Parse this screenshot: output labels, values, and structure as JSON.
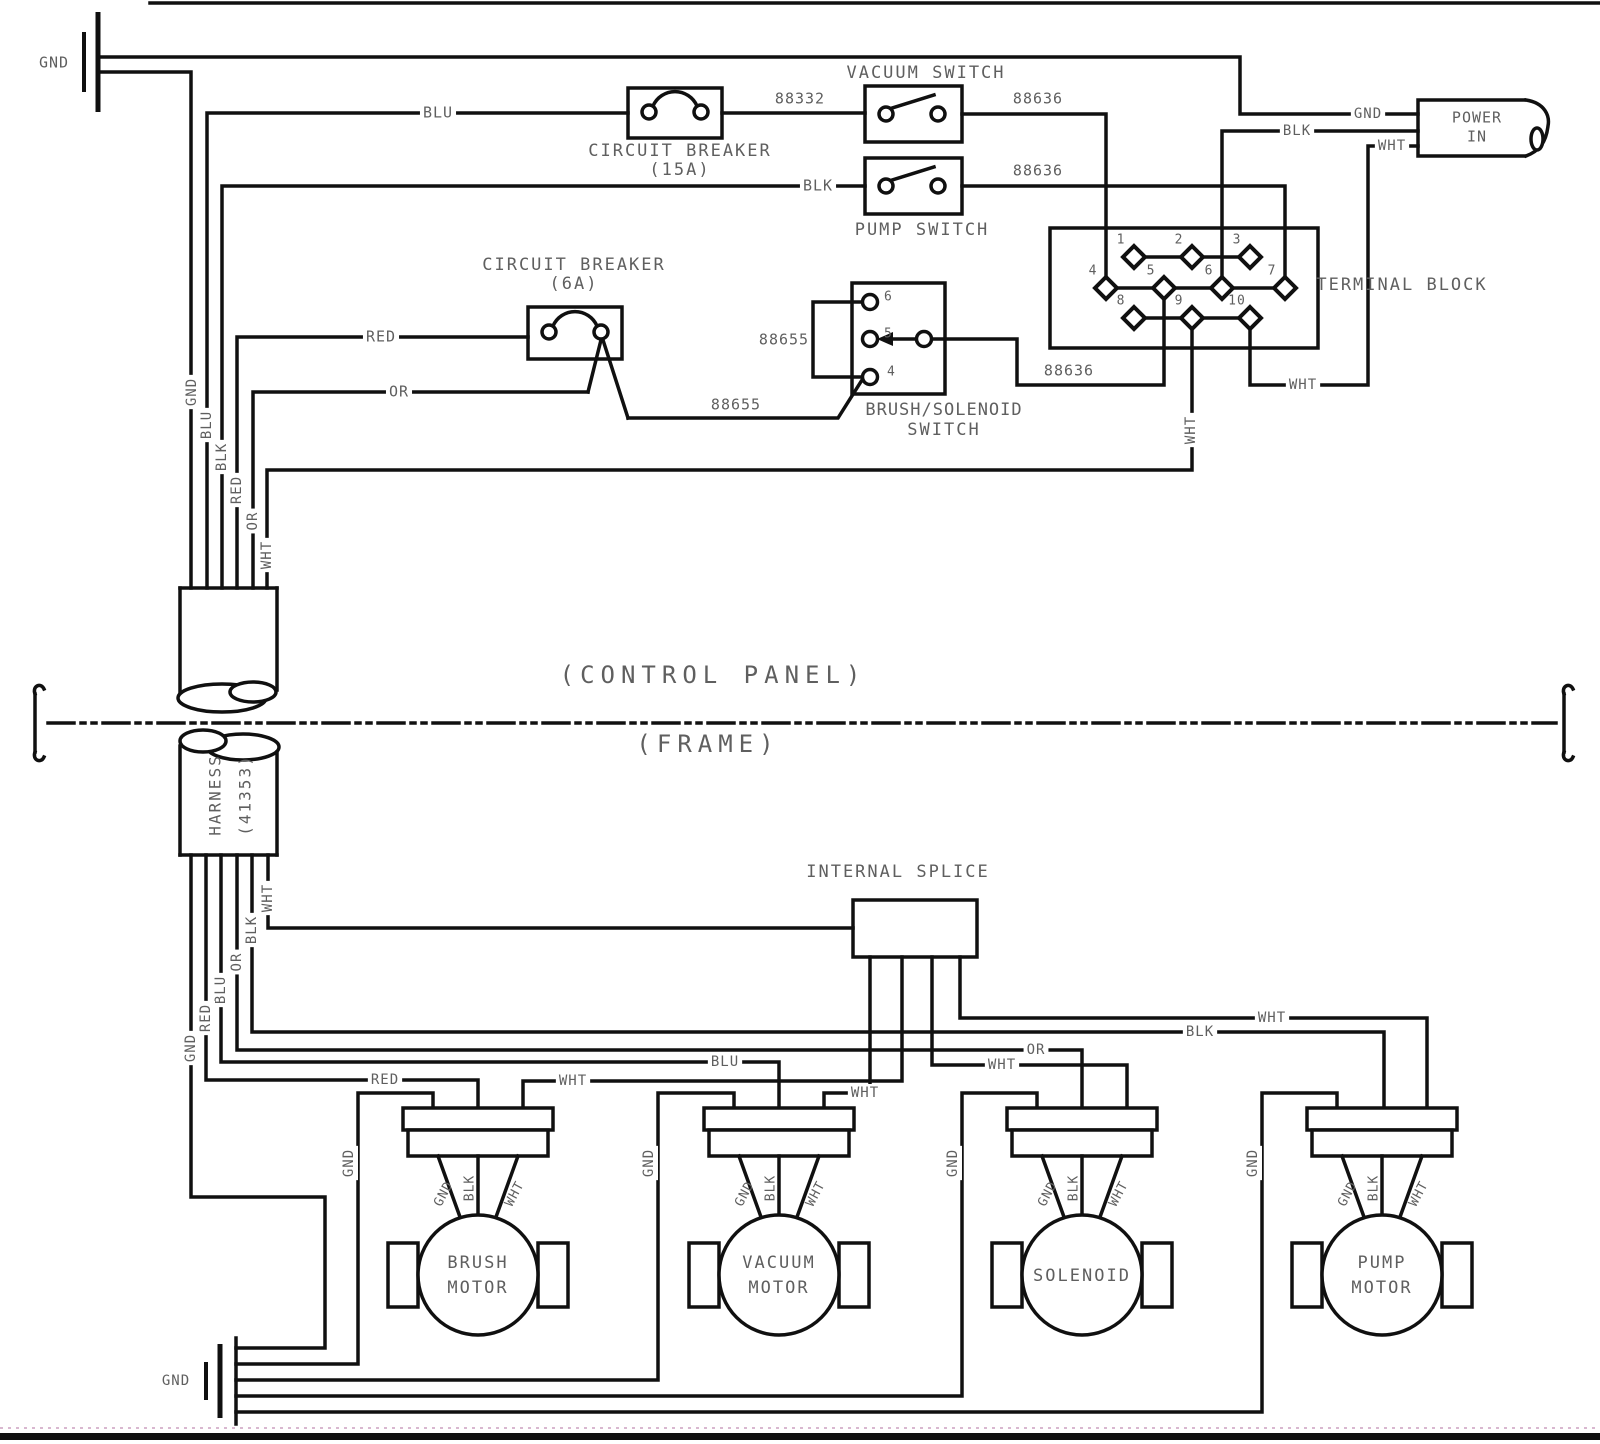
{
  "colors": {
    "line": "#101010",
    "text": "#5f5f5f",
    "accent_dotted": "#d9b8d0"
  },
  "diagram_zones": {
    "upper": "(CONTROL PANEL)",
    "lower": "(FRAME)"
  },
  "power_in": {
    "label_line1": "POWER",
    "label_line2": "IN",
    "wires": [
      "GND",
      "BLK",
      "WHT"
    ]
  },
  "harness": {
    "label_line1": "HARNESS",
    "label_line2": "(41353)",
    "top_wires": [
      "GND",
      "BLU",
      "BLK",
      "RED",
      "OR",
      "WHT"
    ],
    "bottom_wires": [
      "GND",
      "RED",
      "BLU",
      "OR",
      "BLK",
      "WHT"
    ]
  },
  "terminal_block": {
    "label": "TERMINAL BLOCK",
    "terminals": [
      {
        "n": "1",
        "x": 1134,
        "y": 257
      },
      {
        "n": "2",
        "x": 1192,
        "y": 257
      },
      {
        "n": "3",
        "x": 1250,
        "y": 257
      },
      {
        "n": "4",
        "x": 1106,
        "y": 288
      },
      {
        "n": "5",
        "x": 1164,
        "y": 288
      },
      {
        "n": "6",
        "x": 1222,
        "y": 288
      },
      {
        "n": "7",
        "x": 1285,
        "y": 288
      },
      {
        "n": "8",
        "x": 1134,
        "y": 318
      },
      {
        "n": "9",
        "x": 1192,
        "y": 318
      },
      {
        "n": "10",
        "x": 1250,
        "y": 318
      }
    ]
  },
  "brush_solenoid_switch": {
    "label_line1": "BRUSH/SOLENOID",
    "label_line2": "SWITCH",
    "terminal_labels": [
      {
        "t": "6",
        "x": 884,
        "y": 297
      },
      {
        "t": "5",
        "x": 884,
        "y": 334
      },
      {
        "t": "4",
        "x": 887,
        "y": 372
      }
    ]
  },
  "motors": [
    {
      "name": "brush-motor",
      "label_lines": [
        "BRUSH",
        "MOTOR"
      ],
      "cx": 478,
      "gnd_x": 358,
      "bus_y": 1364,
      "fan_labels": [
        "GND",
        "BLK",
        "WHT"
      ],
      "gnd_wire_label": "GND"
    },
    {
      "name": "vacuum-motor",
      "label_lines": [
        "VACUUM",
        "MOTOR"
      ],
      "cx": 779,
      "gnd_x": 658,
      "bus_y": 1380,
      "fan_labels": [
        "GND",
        "BLK",
        "WHT"
      ],
      "gnd_wire_label": "GND"
    },
    {
      "name": "solenoid",
      "label_lines": [
        "SOLENOID"
      ],
      "cx": 1082,
      "gnd_x": 962,
      "bus_y": 1396,
      "fan_labels": [
        "GND",
        "BLK",
        "WHT"
      ],
      "gnd_wire_label": "GND"
    },
    {
      "name": "pump-motor",
      "label_lines": [
        "PUMP",
        "MOTOR"
      ],
      "cx": 1382,
      "gnd_x": 1262,
      "bus_y": 1412,
      "fan_labels": [
        "GND",
        "BLK",
        "WHT"
      ],
      "gnd_wire_label": "GND"
    }
  ],
  "labels": [
    {
      "name": "gnd-label-top-left",
      "text": "GND",
      "x": 54,
      "y": 63,
      "size": 15
    },
    {
      "name": "blu-wire-label",
      "text": "BLU",
      "x": 438,
      "y": 113,
      "size": 15,
      "bg": true
    },
    {
      "name": "circuit-breaker-15a-label-1",
      "text": "CIRCUIT BREAKER",
      "x": 680,
      "y": 151,
      "size": 17,
      "ls": 2
    },
    {
      "name": "circuit-breaker-15a-label-2",
      "text": "(15A)",
      "x": 680,
      "y": 170,
      "size": 17,
      "ls": 2
    },
    {
      "name": "wire-88332-label",
      "text": "88332",
      "x": 800,
      "y": 99,
      "size": 15
    },
    {
      "name": "vacuum-switch-label",
      "text": "VACUUM SWITCH",
      "x": 926,
      "y": 73,
      "size": 17,
      "ls": 2
    },
    {
      "name": "wire-88636-label-1",
      "text": "88636",
      "x": 1038,
      "y": 99,
      "size": 15
    },
    {
      "name": "blk-wire-label",
      "text": "BLK",
      "x": 818,
      "y": 186,
      "size": 15,
      "bg": true
    },
    {
      "name": "pump-switch-label",
      "text": "PUMP SWITCH",
      "x": 922,
      "y": 230,
      "size": 17,
      "ls": 2
    },
    {
      "name": "wire-88636-label-2",
      "text": "88636",
      "x": 1038,
      "y": 171,
      "size": 15
    },
    {
      "name": "power-gnd-label",
      "text": "GND",
      "x": 1368,
      "y": 114,
      "size": 14,
      "bg": true
    },
    {
      "name": "power-blk-label",
      "text": "BLK",
      "x": 1297,
      "y": 131,
      "size": 14,
      "bg": true
    },
    {
      "name": "power-wht-label",
      "text": "WHT",
      "x": 1392,
      "y": 146,
      "size": 14,
      "bg": true
    },
    {
      "name": "power-in-label-1",
      "text": "POWER",
      "x": 1477,
      "y": 118,
      "size": 15
    },
    {
      "name": "power-in-label-2",
      "text": "IN",
      "x": 1477,
      "y": 137,
      "size": 15
    },
    {
      "name": "terminal-block-label",
      "text": "TERMINAL BLOCK",
      "x": 1402,
      "y": 285,
      "size": 17,
      "ls": 2
    },
    {
      "name": "circuit-breaker-6a-label-1",
      "text": "CIRCUIT BREAKER",
      "x": 574,
      "y": 265,
      "size": 17,
      "ls": 2
    },
    {
      "name": "circuit-breaker-6a-label-2",
      "text": "(6A)",
      "x": 574,
      "y": 284,
      "size": 17,
      "ls": 2
    },
    {
      "name": "red-wire-label",
      "text": "RED",
      "x": 381,
      "y": 337,
      "size": 15,
      "bg": true
    },
    {
      "name": "or-wire-label",
      "text": "OR",
      "x": 399,
      "y": 392,
      "size": 15,
      "bg": true
    },
    {
      "name": "wire-88655-label-1",
      "text": "88655",
      "x": 784,
      "y": 340,
      "size": 15
    },
    {
      "name": "wire-88655-label-2",
      "text": "88655",
      "x": 736,
      "y": 405,
      "size": 15
    },
    {
      "name": "wire-88636-label-3",
      "text": "88636",
      "x": 1069,
      "y": 371,
      "size": 15
    },
    {
      "name": "brush-solenoid-switch-label-1",
      "text": "BRUSH/SOLENOID",
      "x": 944,
      "y": 410,
      "size": 17,
      "ls": 1
    },
    {
      "name": "brush-solenoid-switch-label-2",
      "text": "SWITCH",
      "x": 944,
      "y": 430,
      "size": 17,
      "ls": 2
    },
    {
      "name": "wht-vertical-label-t9",
      "text": "WHT",
      "x": 1191,
      "y": 430,
      "size": 14,
      "rot": -90,
      "bg": true
    },
    {
      "name": "wht-wire-label-t10",
      "text": "WHT",
      "x": 1303,
      "y": 385,
      "size": 14,
      "bg": true
    },
    {
      "name": "harness-top-gnd-label",
      "text": "GND",
      "x": 192,
      "y": 392,
      "size": 14,
      "rot": -90,
      "bg": true
    },
    {
      "name": "harness-top-blu-label",
      "text": "BLU",
      "x": 207,
      "y": 425,
      "size": 14,
      "rot": -90,
      "bg": true
    },
    {
      "name": "harness-top-blk-label",
      "text": "BLK",
      "x": 222,
      "y": 457,
      "size": 14,
      "rot": -90,
      "bg": true
    },
    {
      "name": "harness-top-red-label",
      "text": "RED",
      "x": 237,
      "y": 490,
      "size": 14,
      "rot": -90,
      "bg": true
    },
    {
      "name": "harness-top-or-label",
      "text": "OR",
      "x": 253,
      "y": 521,
      "size": 14,
      "rot": -90,
      "bg": true
    },
    {
      "name": "harness-top-wht-label",
      "text": "WHT",
      "x": 267,
      "y": 555,
      "size": 14,
      "rot": -90,
      "bg": true
    },
    {
      "name": "control-panel-label",
      "text": "(CONTROL PANEL)",
      "x": 713,
      "y": 676,
      "size": 24,
      "ls": 6
    },
    {
      "name": "frame-label",
      "text": "(FRAME)",
      "x": 708,
      "y": 745,
      "size": 24,
      "ls": 6
    },
    {
      "name": "harness-label-1",
      "text": "HARNESS",
      "x": 216,
      "y": 795,
      "size": 16,
      "rot": -90,
      "ls": 2
    },
    {
      "name": "harness-label-2",
      "text": "(41353)",
      "x": 246,
      "y": 795,
      "size": 16,
      "rot": -90,
      "ls": 2
    },
    {
      "name": "internal-splice-label",
      "text": "INTERNAL SPLICE",
      "x": 898,
      "y": 872,
      "size": 17,
      "ls": 2
    },
    {
      "name": "harness-bottom-wht-label",
      "text": "WHT",
      "x": 268,
      "y": 898,
      "size": 14,
      "rot": -90,
      "bg": true
    },
    {
      "name": "harness-bottom-blk-label",
      "text": "BLK",
      "x": 252,
      "y": 930,
      "size": 14,
      "rot": -90,
      "bg": true
    },
    {
      "name": "harness-bottom-or-label",
      "text": "OR",
      "x": 237,
      "y": 962,
      "size": 14,
      "rot": -90,
      "bg": true
    },
    {
      "name": "harness-bottom-blu-label",
      "text": "BLU",
      "x": 221,
      "y": 990,
      "size": 14,
      "rot": -90,
      "bg": true
    },
    {
      "name": "harness-bottom-red-label",
      "text": "RED",
      "x": 206,
      "y": 1018,
      "size": 14,
      "rot": -90,
      "bg": true
    },
    {
      "name": "harness-bottom-gnd-label",
      "text": "GND",
      "x": 191,
      "y": 1048,
      "size": 14,
      "rot": -90,
      "bg": true
    },
    {
      "name": "wht-wire-label-pump",
      "text": "WHT",
      "x": 1272,
      "y": 1018,
      "size": 14,
      "bg": true
    },
    {
      "name": "blk-wire-label-pump",
      "text": "BLK",
      "x": 1200,
      "y": 1032,
      "size": 14,
      "bg": true
    },
    {
      "name": "or-wire-label-solenoid",
      "text": "OR",
      "x": 1036,
      "y": 1050,
      "size": 14,
      "bg": true
    },
    {
      "name": "wht-wire-label-solenoid",
      "text": "WHT",
      "x": 1002,
      "y": 1065,
      "size": 14,
      "bg": true
    },
    {
      "name": "blu-wire-label-vacuum",
      "text": "BLU",
      "x": 725,
      "y": 1062,
      "size": 14,
      "bg": true
    },
    {
      "name": "wht-wire-label-vacuum",
      "text": "WHT",
      "x": 865,
      "y": 1093,
      "size": 14,
      "bg": true
    },
    {
      "name": "red-wire-label-brush",
      "text": "RED",
      "x": 385,
      "y": 1080,
      "size": 14,
      "bg": true
    },
    {
      "name": "wht-wire-label-brush",
      "text": "WHT",
      "x": 573,
      "y": 1081,
      "size": 14,
      "bg": true
    },
    {
      "name": "gnd-label-bottom-left",
      "text": "GND",
      "x": 176,
      "y": 1381,
      "size": 14
    }
  ]
}
